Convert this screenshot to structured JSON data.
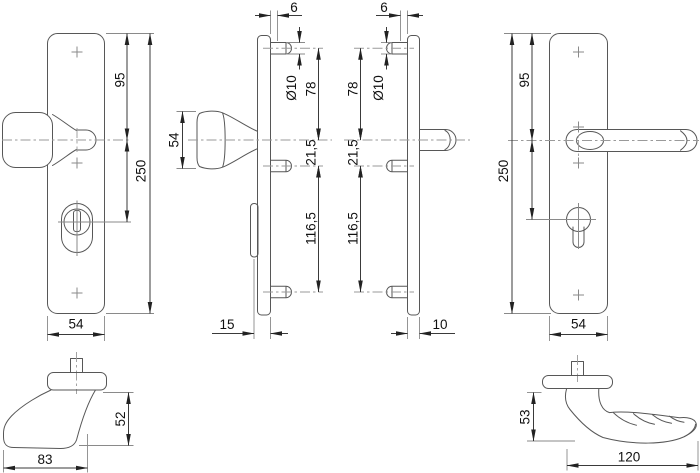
{
  "figures": {
    "knob_plate_front": {
      "dims": {
        "top_to_knob": "95",
        "total_height": "250",
        "width": "54"
      }
    },
    "knob_plate_side": {
      "dims": {
        "stud_step": "6",
        "stud_diameter": "Ø10",
        "top_stud_to_knob": "78",
        "knob_to_mid_stud": "21,5",
        "mid_to_bottom_stud": "116,5",
        "knob_height": "54",
        "plate_depth": "15"
      }
    },
    "lever_plate_side": {
      "dims": {
        "stud_step": "6",
        "stud_diameter": "Ø10",
        "top_stud_to_handle": "78",
        "handle_to_mid_stud": "21,5",
        "mid_to_bottom_stud": "116,5",
        "plate_depth": "10"
      }
    },
    "lever_plate_front": {
      "dims": {
        "top_to_handle": "95",
        "total_height": "250",
        "width": "54"
      }
    },
    "knob_profile": {
      "dims": {
        "depth": "83",
        "height": "52"
      }
    },
    "lever_profile": {
      "dims": {
        "length": "120",
        "height": "53"
      }
    }
  },
  "colors": {
    "outline": "#575757",
    "dimension": "#3a3a3a",
    "extension": "#8a8a8a",
    "background": "#ffffff"
  }
}
